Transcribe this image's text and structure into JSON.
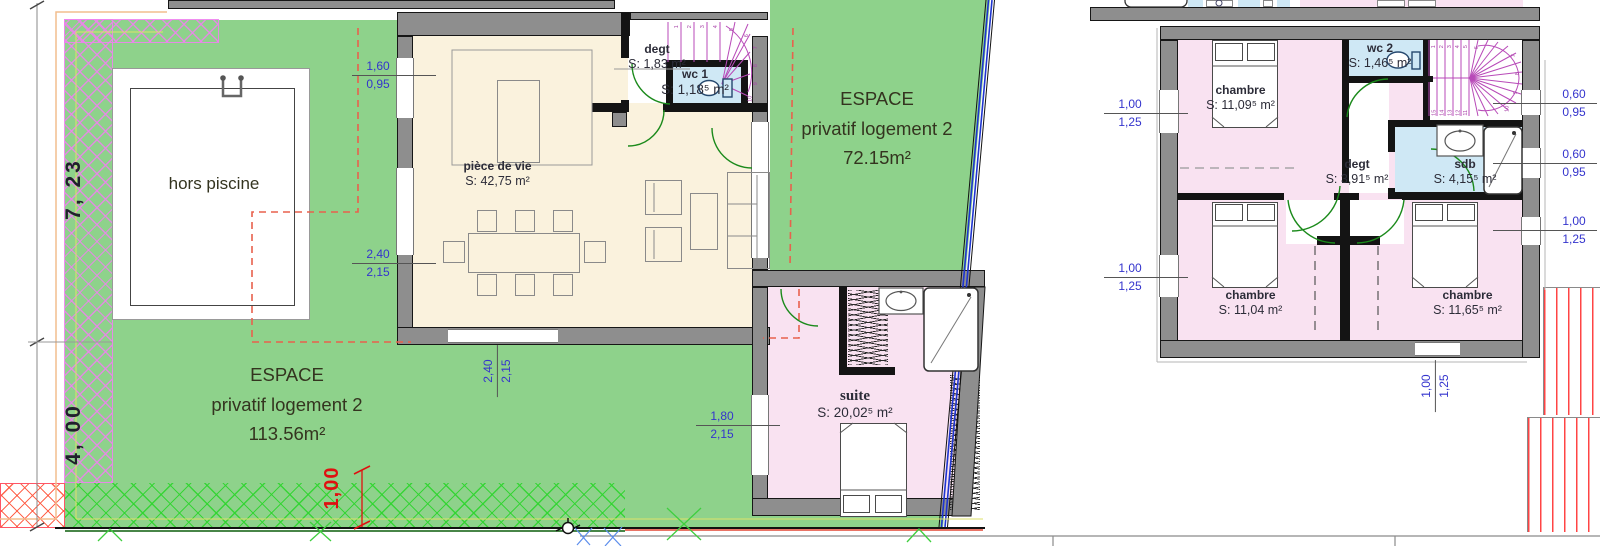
{
  "ground_plan": {
    "pool_label": "hors piscine",
    "garden_left": {
      "l1": "ESPACE",
      "l2": "privatif logement 2",
      "l3": "113.56m²"
    },
    "garden_right": {
      "l1": "ESPACE",
      "l2": "privatif logement 2",
      "l3": "72.15m²"
    },
    "rooms": {
      "piece_de_vie": {
        "name": "pièce de vie",
        "area": "S: 42,75 m²"
      },
      "degt": {
        "name": "degt",
        "area": "S: 1,83 m²"
      },
      "wc1": {
        "name": "wc 1",
        "area": "S: 1,18⁵ m²"
      },
      "suite": {
        "name": "suite",
        "area": "S: 20,02⁵ m²"
      }
    },
    "dims": {
      "margin_upper": "7, 23",
      "margin_lower": "4, 00",
      "red_offset": "1,00",
      "win1": {
        "a": "1,60",
        "b": "0,95"
      },
      "win2": {
        "a": "2,40",
        "b": "2,15"
      },
      "win3": {
        "a": "2,40",
        "b": "2,15"
      },
      "win4": {
        "a": "1,80",
        "b": "2,15"
      }
    },
    "stair_numbers": [
      "1",
      "2",
      "3",
      "4",
      "5",
      "6",
      "7",
      "8",
      "9",
      "10"
    ]
  },
  "floor_plan": {
    "rooms": {
      "chambre1": {
        "name": "chambre",
        "area": "S: 11,09⁵ m²"
      },
      "wc2": {
        "name": "wc 2",
        "area": "S: 1,46⁵ m²"
      },
      "degt": {
        "name": "degt",
        "area": "S: 3,91⁵ m²"
      },
      "sdb": {
        "name": "sdb",
        "area": "S: 4,15⁵ m²"
      },
      "chambre2": {
        "name": "chambre",
        "area": "S: 11,04 m²"
      },
      "chambre3": {
        "name": "chambre",
        "area": "S: 11,65⁵ m²"
      }
    },
    "dims": {
      "win1": {
        "a": "1,00",
        "b": "1,25"
      },
      "win2": {
        "a": "1,00",
        "b": "1,25"
      },
      "win3": {
        "a": "1,00",
        "b": "1,25"
      },
      "right1": {
        "a": "0,60",
        "b": "0,95"
      },
      "right2": {
        "a": "0,60",
        "b": "0,95"
      },
      "right3": {
        "a": "1,00",
        "b": "1,25"
      }
    },
    "stair_numbers": [
      "1",
      "2",
      "3",
      "4",
      "5",
      "6",
      "7",
      "8",
      "9",
      "10",
      "11",
      "12",
      "13",
      "14",
      "15"
    ]
  },
  "colors": {
    "garden": "#8ed28b",
    "room_cream": "#faf2dd",
    "room_pink": "#f9e2f1",
    "room_blue": "#cfe8f5",
    "wall_gray": "#8e8e8e",
    "dim_blue": "#3434cd",
    "stair_magenta": "#b84ab8",
    "door_green": "#1b8a1b",
    "boundary_blue": "#1f35cf",
    "red_dash": "#e8614d",
    "offset_red": "#e01010"
  }
}
